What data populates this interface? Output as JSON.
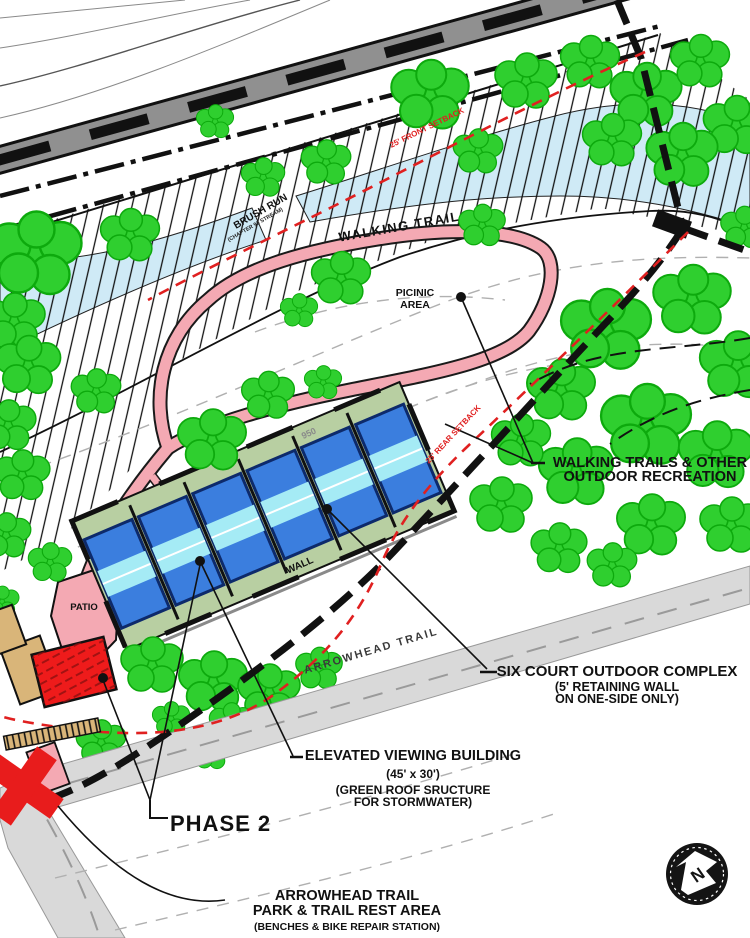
{
  "map_labels": {
    "walking_trail": "WALKING TRAIL",
    "brush_run": "BRUSH RUN",
    "brush_run_detail": "(CHAPTER 93 STREAM)",
    "picnic_line1": "PICINIC",
    "picnic_line2": "AREA",
    "patio": "PATIO",
    "wall": "WALL",
    "contour_950": "950",
    "arrowhead_trail": "ARROWHEAD TRAIL",
    "front_setback": "25' FRONT SETBACK",
    "rear_setback": "25' REAR SETBACK",
    "north": "N"
  },
  "callouts": {
    "walking_trails": {
      "line1": "WALKING TRAILS & OTHER",
      "line2": "OUTDOOR RECREATION"
    },
    "six_court": {
      "line1": "SIX COURT OUTDOOR COMPLEX",
      "line2": "(5' RETAINING WALL",
      "line3": "ON ONE-SIDE ONLY)"
    },
    "elevated_building": {
      "line1": "ELEVATED VIEWING BUILDING",
      "line2": "(45' x 30')",
      "line3": "(GREEN ROOF SRUCTURE",
      "line4": "FOR STORMWATER)"
    },
    "phase": {
      "label": "PHASE 2"
    },
    "rest_area": {
      "line1": "ARROWHEAD TRAIL",
      "line2": "PARK & TRAIL REST AREA",
      "line3": "(BENCHES & BIKE REPAIR STATION)"
    }
  },
  "colors": {
    "tree_green": "#2fcf2f",
    "court_blue": "#3b7ede",
    "court_stripe_cyan": "#a5ebf5",
    "court_platform_green": "#b8cfa2",
    "trail_pink": "#f4a9b3",
    "building_red": "#ee1b1b",
    "existing_building_tan": "#d9b579",
    "stream_blue": "#cfeaf6",
    "trail_gray": "#d9d9d9",
    "railroad_gray": "#909090",
    "setback_red": "#e02020"
  }
}
